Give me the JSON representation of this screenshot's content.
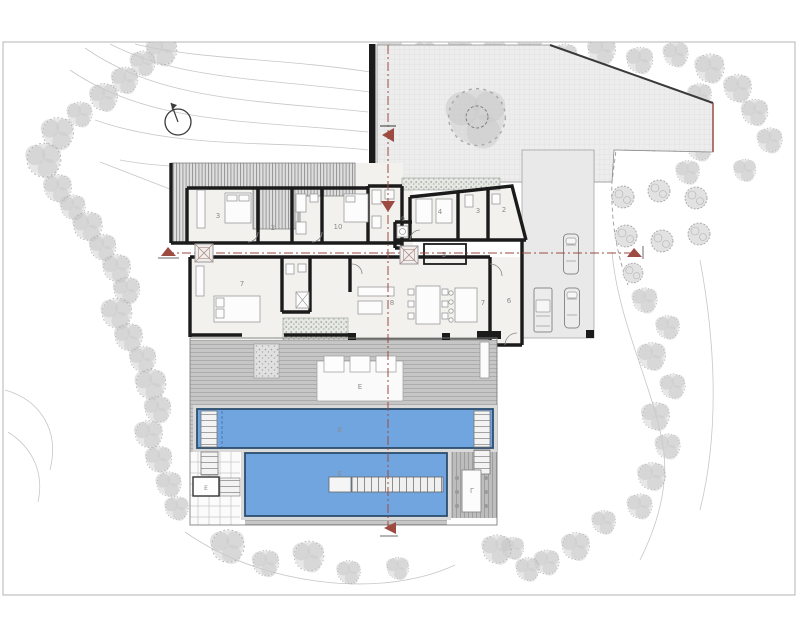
{
  "plan": {
    "drawing_type": "villa site plan with pools",
    "rooms": [
      {
        "id": "bedroom-upper-left",
        "label": "3"
      },
      {
        "id": "bath-upper-left",
        "label": "2"
      },
      {
        "id": "bedroom-upper-mid",
        "label": "10"
      },
      {
        "id": "bedroom-upper-right",
        "label": "4"
      },
      {
        "id": "bath-upper-right-1",
        "label": "3"
      },
      {
        "id": "bath-upper-right-2",
        "label": "2"
      },
      {
        "id": "utility-room",
        "label": "9"
      },
      {
        "id": "hall-room",
        "label": "5"
      },
      {
        "id": "bedroom-lower-left",
        "label": "7"
      },
      {
        "id": "living-room",
        "label": "8"
      },
      {
        "id": "kitchen-area",
        "label": "7"
      },
      {
        "id": "entry-room",
        "label": "6"
      }
    ],
    "outdoor_labels": [
      {
        "id": "deck-lounge",
        "label": "E"
      },
      {
        "id": "upper-pool",
        "label": "E"
      },
      {
        "id": "lower-pool",
        "label": "E"
      },
      {
        "id": "pergola-dining",
        "label": "Γ"
      },
      {
        "id": "pool-room",
        "label": "E"
      }
    ],
    "colors": {
      "paper": "#ffffff",
      "frame": "#b5b5b5",
      "walls": "#1b1b1b",
      "room_fill": "#f2f1ee",
      "roof_stripe": "#8f8f8f",
      "courtyard": "#ededed",
      "deck": "#c6c6c6",
      "pool_water": "#71a5df",
      "pool_edge": "#2c4e6e",
      "vegetation": "#c9c9c9",
      "section_line": "#9c4a42",
      "label_text": "#8c8c8c"
    }
  }
}
